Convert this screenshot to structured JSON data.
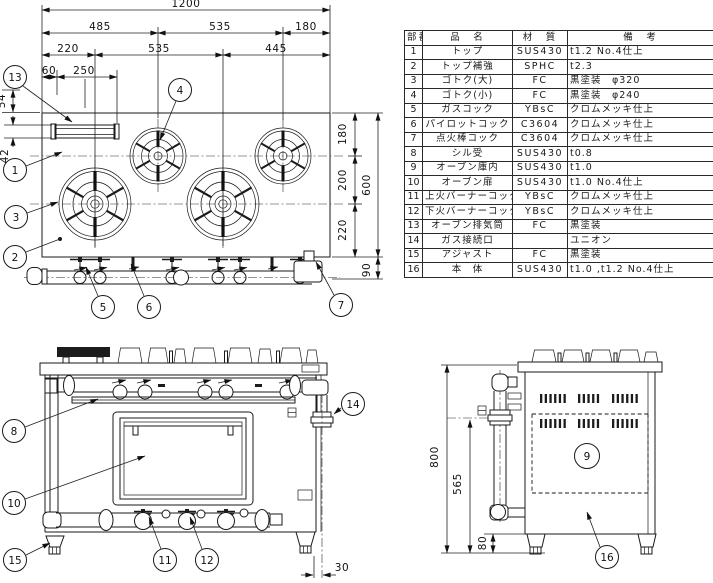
{
  "table": {
    "headers": {
      "no": "部番",
      "name": "品　名",
      "material": "材　質",
      "remarks": "備　考"
    },
    "rows": [
      {
        "no": "1",
        "name": "トップ",
        "material": "SUS430",
        "remarks": "t1.2 No.4仕上"
      },
      {
        "no": "2",
        "name": "トップ補強",
        "material": "SPHC",
        "remarks": "t2.3"
      },
      {
        "no": "3",
        "name": "ゴトク(大)",
        "material": "FC",
        "remarks": "黒塗装　φ320"
      },
      {
        "no": "4",
        "name": "ゴトク(小)",
        "material": "FC",
        "remarks": "黒塗装　φ240"
      },
      {
        "no": "5",
        "name": "ガスコック",
        "material": "YBsC",
        "remarks": "クロムメッキ仕上"
      },
      {
        "no": "6",
        "name": "パイロットコック",
        "material": "C3604",
        "remarks": "クロムメッキ仕上"
      },
      {
        "no": "7",
        "name": "点火棒コック",
        "material": "C3604",
        "remarks": "クロムメッキ仕上"
      },
      {
        "no": "8",
        "name": "シル受",
        "material": "SUS430",
        "remarks": "t0.8"
      },
      {
        "no": "9",
        "name": "オーブン庫内",
        "material": "SUS430",
        "remarks": "t1.0"
      },
      {
        "no": "10",
        "name": "オーブン扉",
        "material": "SUS430",
        "remarks": "t1.0 No.4仕上"
      },
      {
        "no": "11",
        "name": "上火バーナーコック",
        "material": "YBsC",
        "remarks": "クロムメッキ仕上"
      },
      {
        "no": "12",
        "name": "下火バーナーコック",
        "material": "YBsC",
        "remarks": "クロムメッキ仕上"
      },
      {
        "no": "13",
        "name": "オーブン排気筒",
        "material": "FC",
        "remarks": "黒塗装"
      },
      {
        "no": "14",
        "name": "ガス接続口",
        "material": "",
        "remarks": "ユニオン"
      },
      {
        "no": "15",
        "name": "アジャスト",
        "material": "FC",
        "remarks": "黒塗装"
      },
      {
        "no": "16",
        "name": "本　体",
        "material": "SUS430",
        "remarks": "t1.0 ,t1.2 No.4仕上"
      }
    ]
  },
  "top_view": {
    "dims": {
      "overall_width": "1200",
      "widths_a": [
        "485",
        "535",
        "180"
      ],
      "widths_b": [
        "220",
        "535",
        "445"
      ],
      "widths_c": [
        "60",
        "250"
      ],
      "back_edge": [
        "54",
        "42"
      ],
      "depth": [
        "180",
        "200",
        "220"
      ],
      "overall_depth": "600",
      "manifold_offset": "90"
    },
    "callouts": [
      "13",
      "4",
      "1",
      "3",
      "2",
      "5",
      "6",
      "7"
    ]
  },
  "front_view": {
    "dims": {
      "gas_pipe_offset": "30"
    },
    "callouts": [
      "8",
      "10",
      "11",
      "12",
      "15",
      "14"
    ]
  },
  "side_view": {
    "dims": {
      "overall_height": "800",
      "gas_inlet_height": "565",
      "adjuster_height": "80"
    },
    "callouts": [
      "9",
      "16"
    ]
  }
}
